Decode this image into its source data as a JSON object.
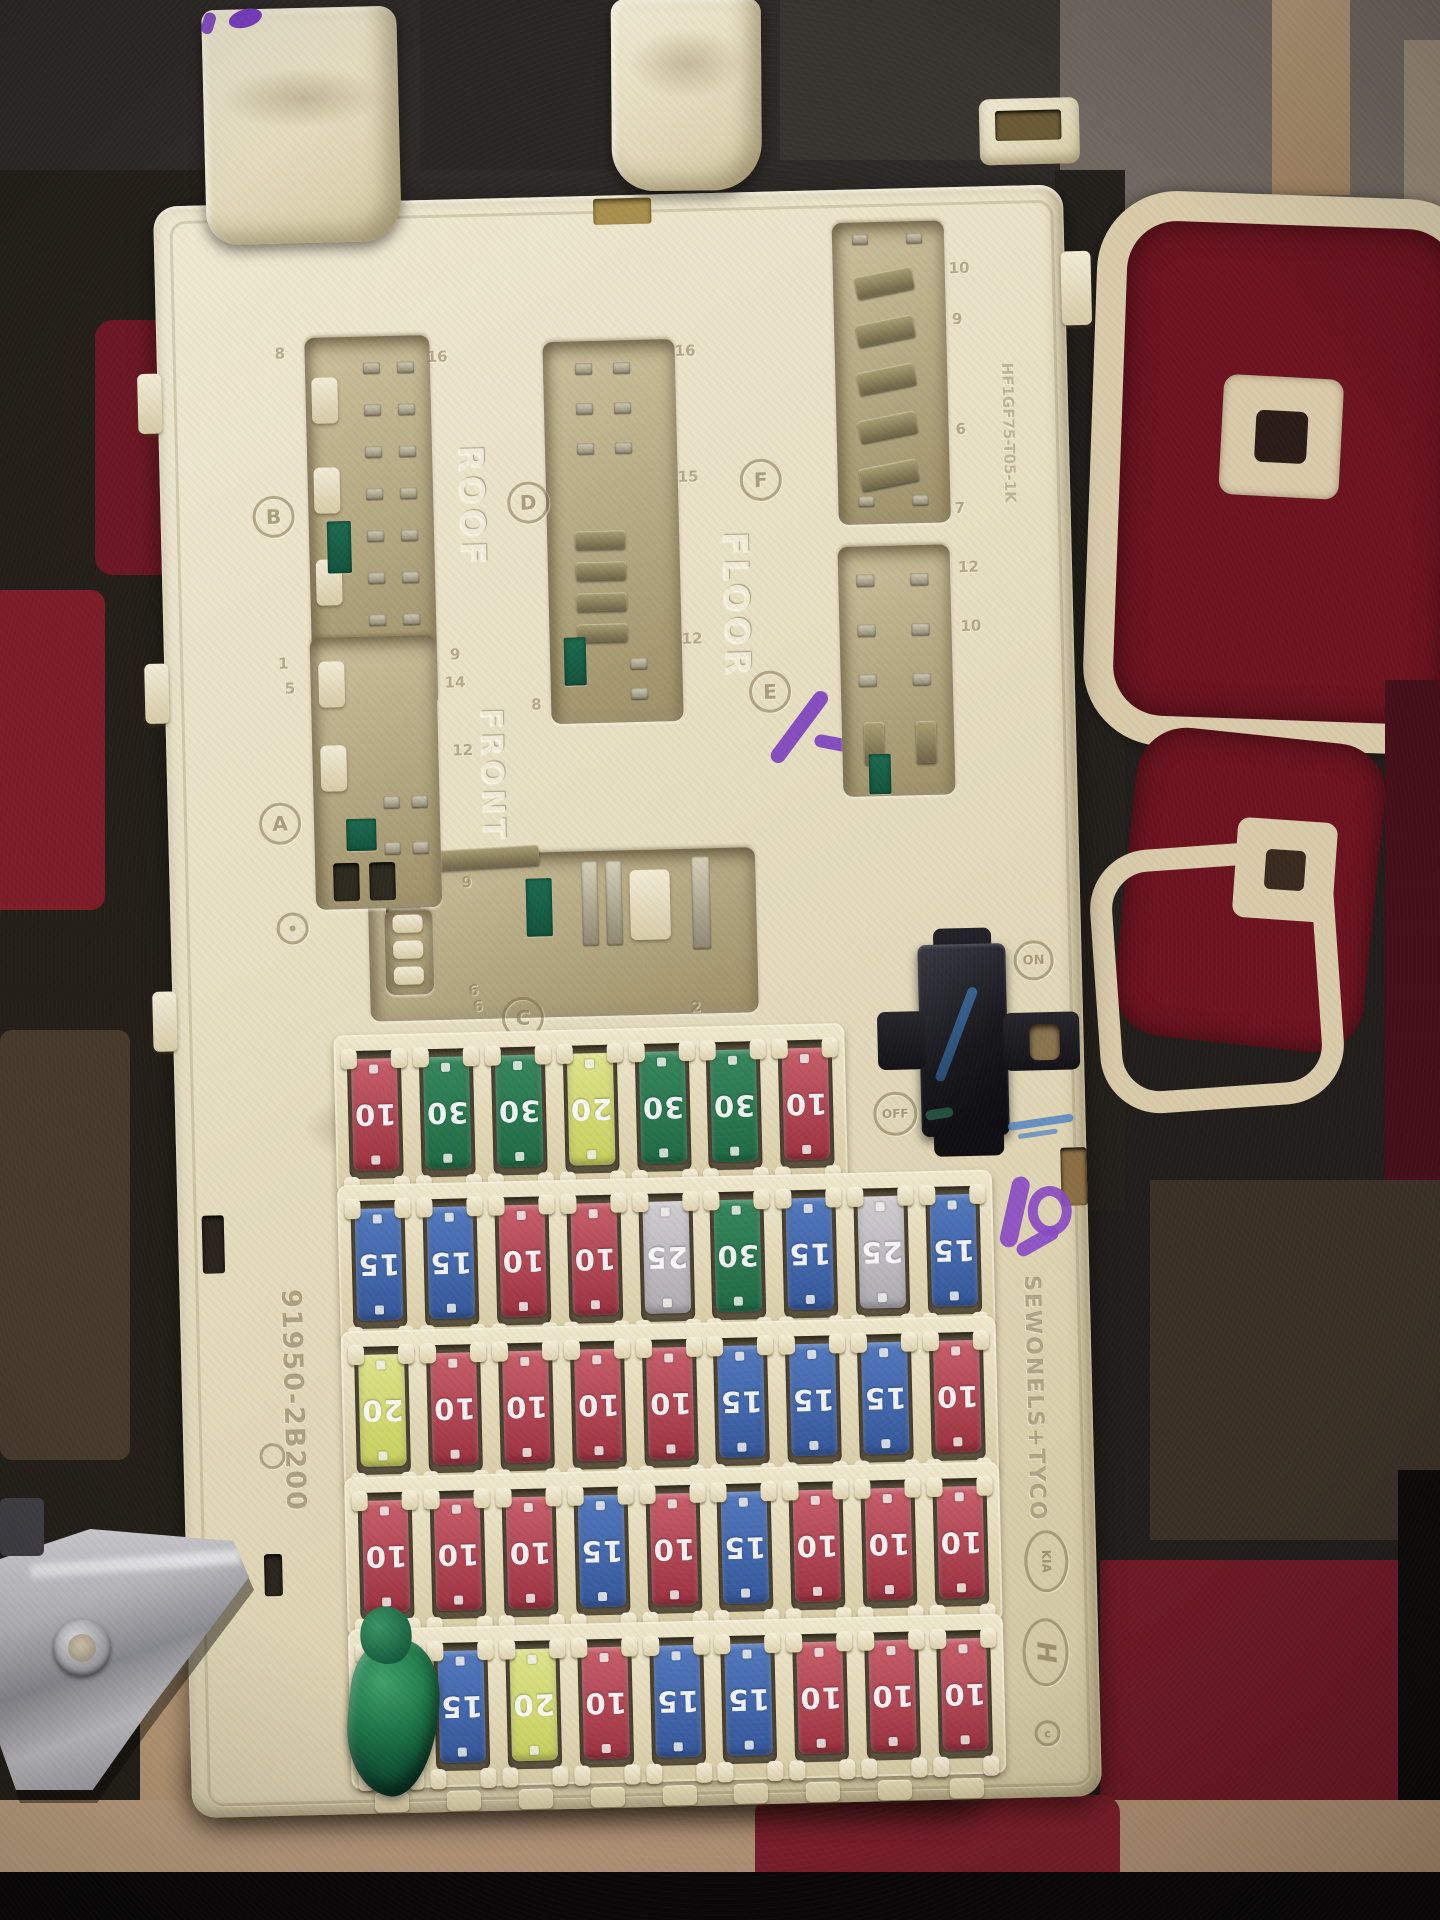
{
  "embossed": {
    "roof": "ROOF",
    "floor": "FLOOR",
    "front": "FRONT",
    "on": "ON",
    "off": "OFF",
    "part_number": "91950-2B200",
    "mold_code": "HF1GF75-T05-1K",
    "maker_text": "SEWONELS+TYCO",
    "kia_logo": "KIA",
    "hyundai_logo": "H",
    "copyright_mark": "c"
  },
  "connector_labels": [
    {
      "id": "B",
      "letter": "B",
      "pin_numbers": [
        "8",
        "16",
        "1",
        "9"
      ]
    },
    {
      "id": "D",
      "letter": "D",
      "pin_numbers": [
        "16",
        "15",
        "12",
        "8"
      ]
    },
    {
      "id": "F",
      "letter": "F",
      "pin_numbers": [
        "10",
        "9",
        "6",
        "7"
      ]
    },
    {
      "id": "E",
      "letter": "E",
      "pin_numbers": [
        "12",
        "10"
      ]
    },
    {
      "id": "A",
      "letter": "A",
      "pin_numbers": [
        "5",
        "14",
        "12",
        "9",
        "6"
      ]
    },
    {
      "id": "C",
      "letter": "C",
      "pin_numbers": [
        "6",
        "2"
      ]
    }
  ],
  "fuse_rows": [
    {
      "row": 1,
      "fuses": [
        {
          "amps": "10",
          "color": "red"
        },
        {
          "amps": "30",
          "color": "green"
        },
        {
          "amps": "30",
          "color": "green"
        },
        {
          "amps": "20",
          "color": "yellow"
        },
        {
          "amps": "30",
          "color": "green"
        },
        {
          "amps": "30",
          "color": "green"
        },
        {
          "amps": "10",
          "color": "red"
        }
      ]
    },
    {
      "row": 2,
      "fuses": [
        {
          "amps": "15",
          "color": "blue"
        },
        {
          "amps": "15",
          "color": "blue"
        },
        {
          "amps": "10",
          "color": "red"
        },
        {
          "amps": "10",
          "color": "red"
        },
        {
          "amps": "25",
          "color": "gray"
        },
        {
          "amps": "30",
          "color": "green"
        },
        {
          "amps": "15",
          "color": "blue"
        },
        {
          "amps": "25",
          "color": "gray"
        },
        {
          "amps": "15",
          "color": "blue"
        }
      ]
    },
    {
      "row": 3,
      "fuses": [
        {
          "amps": "20",
          "color": "yellow"
        },
        {
          "amps": "10",
          "color": "red"
        },
        {
          "amps": "10",
          "color": "red"
        },
        {
          "amps": "10",
          "color": "red"
        },
        {
          "amps": "10",
          "color": "red"
        },
        {
          "amps": "15",
          "color": "blue"
        },
        {
          "amps": "15",
          "color": "blue"
        },
        {
          "amps": "15",
          "color": "blue"
        },
        {
          "amps": "10",
          "color": "red"
        }
      ]
    },
    {
      "row": 4,
      "fuses": [
        {
          "amps": "10",
          "color": "red"
        },
        {
          "amps": "10",
          "color": "red"
        },
        {
          "amps": "10",
          "color": "red"
        },
        {
          "amps": "15",
          "color": "blue"
        },
        {
          "amps": "10",
          "color": "red"
        },
        {
          "amps": "15",
          "color": "blue"
        },
        {
          "amps": "10",
          "color": "red"
        },
        {
          "amps": "10",
          "color": "red"
        },
        {
          "amps": "10",
          "color": "red"
        }
      ]
    },
    {
      "row": 5,
      "fuses": [
        {
          "amps": "",
          "color": "putty"
        },
        {
          "amps": "15",
          "color": "blue"
        },
        {
          "amps": "20",
          "color": "yellow"
        },
        {
          "amps": "10",
          "color": "red"
        },
        {
          "amps": "15",
          "color": "blue"
        },
        {
          "amps": "15",
          "color": "blue"
        },
        {
          "amps": "10",
          "color": "red"
        },
        {
          "amps": "10",
          "color": "red"
        },
        {
          "amps": "10",
          "color": "red"
        }
      ]
    }
  ],
  "fuse_palette": {
    "red": {
      "light": "#c85f6b",
      "dark": "#9c3240"
    },
    "green": {
      "light": "#37875d",
      "dark": "#1f6b45"
    },
    "yellow": {
      "light": "#dde38b",
      "dark": "#c8d05e"
    },
    "blue": {
      "light": "#5379bd",
      "dark": "#35589b"
    },
    "gray": {
      "light": "#d0cdd0",
      "dark": "#aeabb2"
    }
  },
  "colors": {
    "box_plastic": "#e7dfc2",
    "cavity_shadow": "#b3a781",
    "carpet_dark": "#1f1b18",
    "carpet_red": "#6d1824",
    "carpet_tan": "#b6977a",
    "carpet_cream": "#d9cbaa",
    "relay_black": "#17171c",
    "metal_bracket": "#b9b9bf",
    "putty_green": "#1f7a4a",
    "marker_purple": "#7b3fc0",
    "marker_blue": "#4a7fc4"
  }
}
